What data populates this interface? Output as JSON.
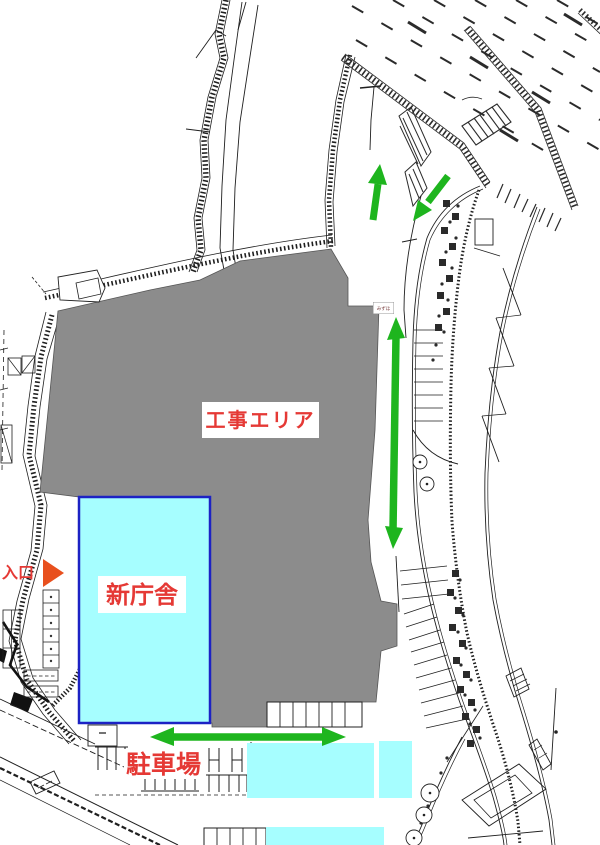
{
  "labels": {
    "construction_area": "工事エリア",
    "new_building": "新庁舎",
    "entrance": "入口",
    "parking": "駐車場",
    "small_sign": "みずほ"
  },
  "colors": {
    "construction_fill": "#8c8c8c",
    "building_fill": "#a6feff",
    "building_border": "#1c22c4",
    "canopy_fill": "#a6feff",
    "arrow_green": "#1eb51e",
    "label_red": "#e53935",
    "entrance_tri": "#e8501e",
    "line_dark": "#1f1f1f"
  }
}
